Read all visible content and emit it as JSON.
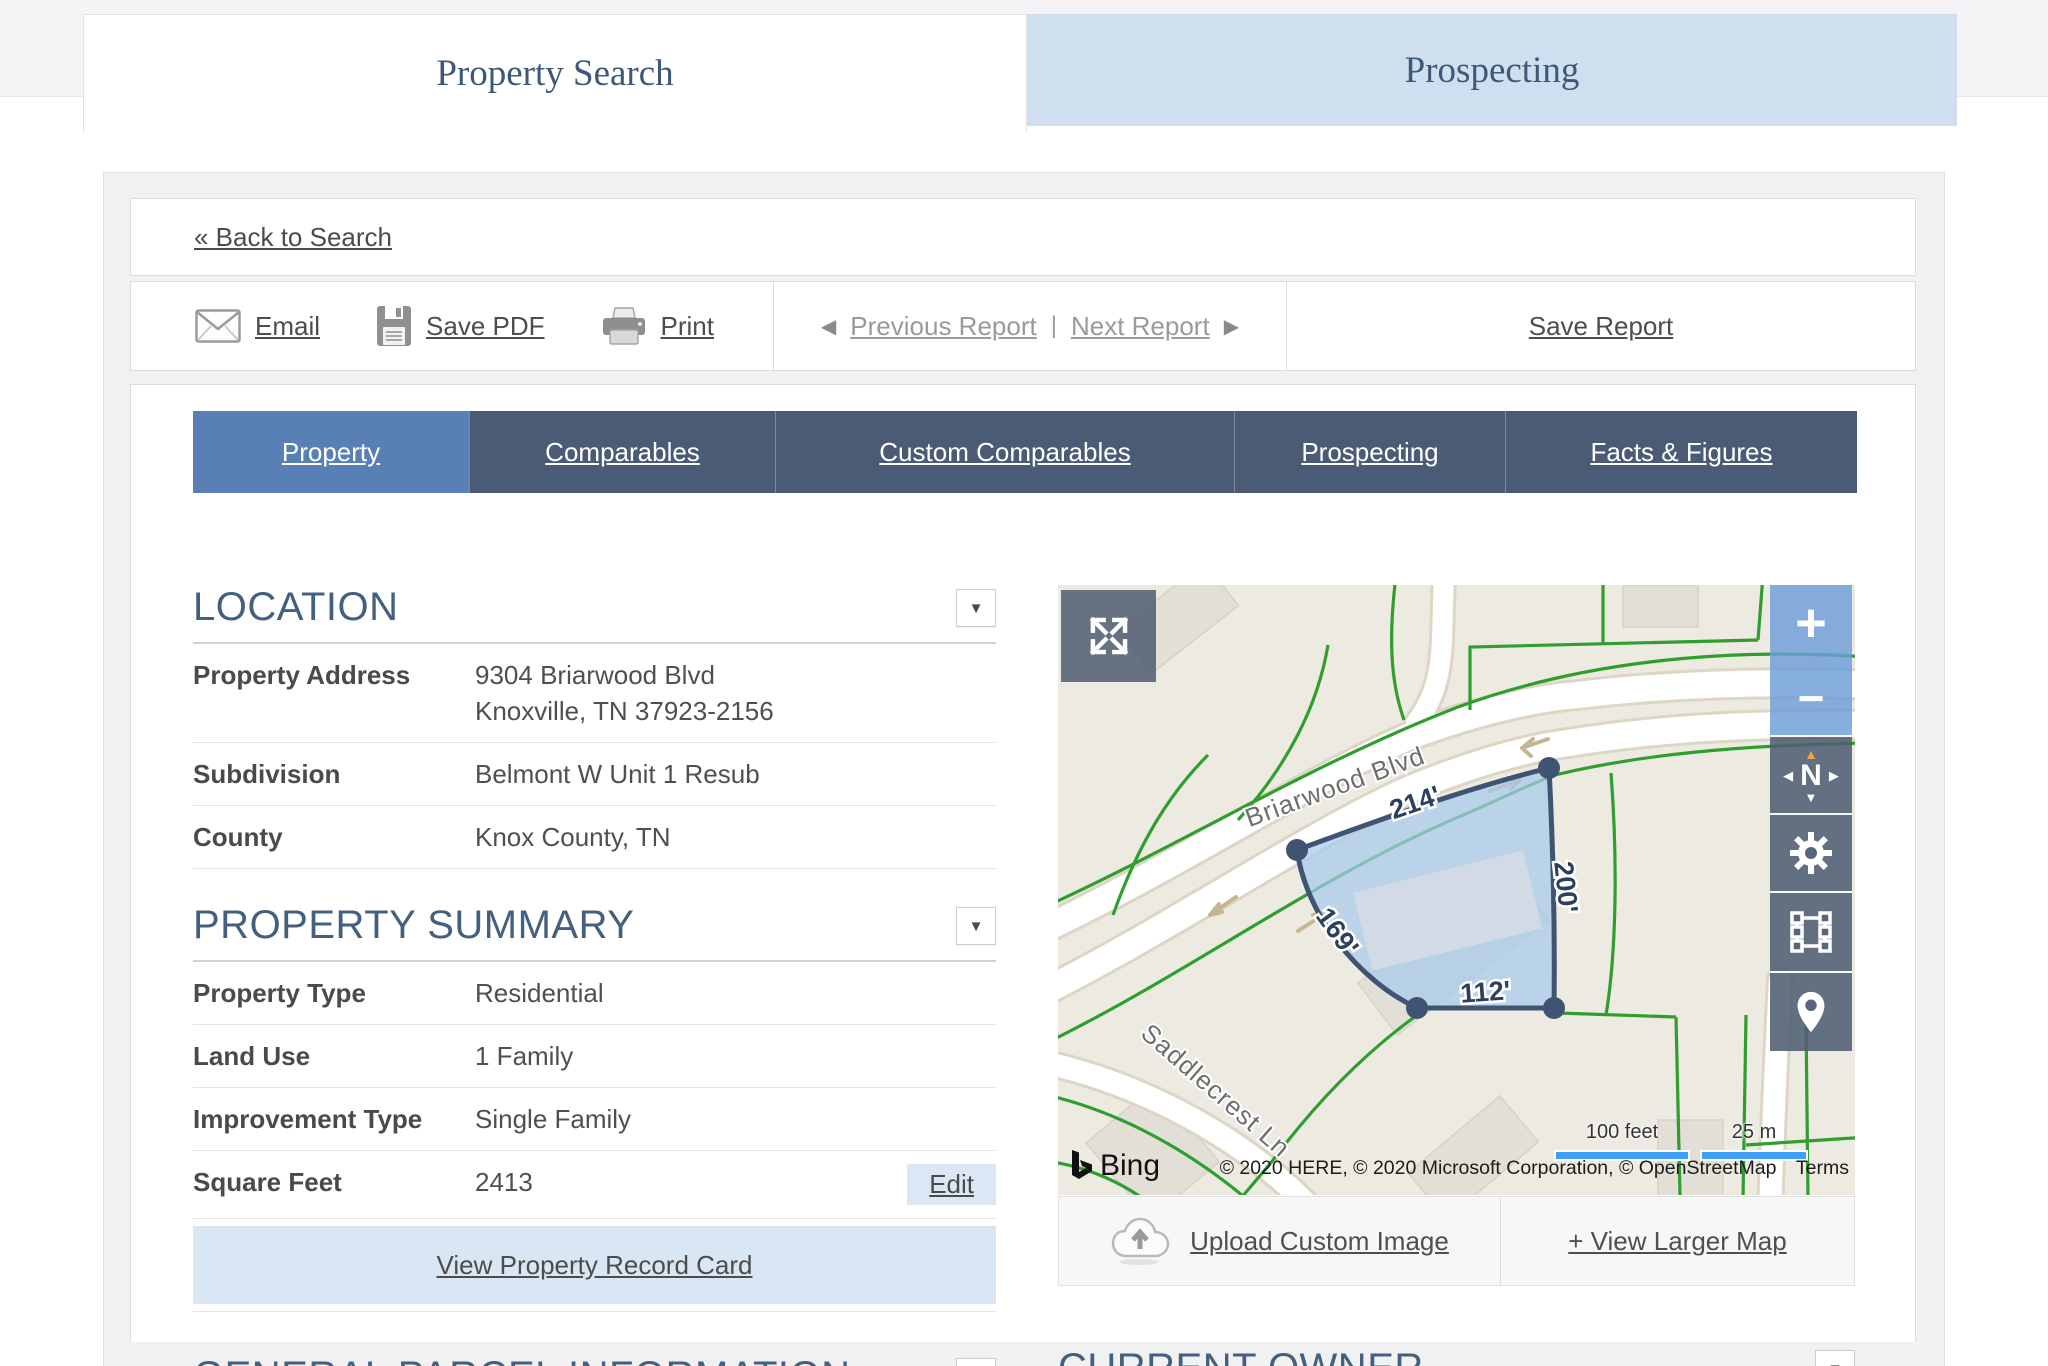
{
  "header_tabs": {
    "property_search": "Property Search",
    "prospecting": "Prospecting"
  },
  "back_link": "« Back to Search",
  "toolbar": {
    "email": "Email",
    "save_pdf": "Save PDF",
    "print": "Print",
    "previous_report": "Previous Report",
    "next_report": "Next Report",
    "divider": "|",
    "save_report": "Save Report",
    "prev_arrow": "◀",
    "next_arrow": "▶"
  },
  "nav_tabs": {
    "property": "Property",
    "comparables": "Comparables",
    "custom_comparables": "Custom Comparables",
    "prospecting": "Prospecting",
    "facts_figures": "Facts & Figures"
  },
  "location": {
    "title": "LOCATION",
    "property_address_label": "Property Address",
    "property_address_line1": "9304 Briarwood Blvd",
    "property_address_line2": "Knoxville, TN 37923-2156",
    "subdivision_label": "Subdivision",
    "subdivision_value": "Belmont W Unit 1 Resub",
    "county_label": "County",
    "county_value": "Knox County, TN"
  },
  "property_summary": {
    "title": "PROPERTY SUMMARY",
    "property_type_label": "Property Type",
    "property_type_value": "Residential",
    "land_use_label": "Land Use",
    "land_use_value": "1 Family",
    "improvement_type_label": "Improvement Type",
    "improvement_type_value": "Single Family",
    "square_feet_label": "Square Feet",
    "square_feet_value": "2413",
    "edit_label": "Edit",
    "record_card_link": "View Property Record Card"
  },
  "general_parcel_title": "GENERAL PARCEL INFORMATION",
  "current_owner_title": "CURRENT OWNER",
  "collapse_arrow": "▼",
  "map": {
    "street_briarwood": "Briarwood Blvd",
    "street_saddlecrest": "Saddlecrest Ln",
    "dim_top": "214'",
    "dim_right": "200'",
    "dim_left": "169'",
    "dim_bottom": "112'",
    "zoom_in": "+",
    "zoom_out": "−",
    "compass_n": "N",
    "compass_up": "▲",
    "compass_down": "▼",
    "compass_left": "◀",
    "compass_right": "▶",
    "scale_feet": "100 feet",
    "scale_meters": "25 m",
    "bing_label": "Bing",
    "attribution": "© 2020 HERE, © 2020 Microsoft Corporation, © OpenStreetMap",
    "terms": "Terms",
    "upload_label": "Upload Custom Image",
    "view_larger_label": "+ View Larger Map"
  },
  "colors": {
    "nav_tab_active": "#5880b4",
    "nav_tab_inactive": "#4b5b76",
    "heading": "#44607f",
    "prospecting_tab_bg": "#cfdfef",
    "parcel_fill": "#aecbe8",
    "parcel_stroke": "#3f5472",
    "map_green": "#2f9e2f",
    "scale_bar_blue": "#3fa0f4",
    "record_bar_bg": "#d9e6f4"
  }
}
